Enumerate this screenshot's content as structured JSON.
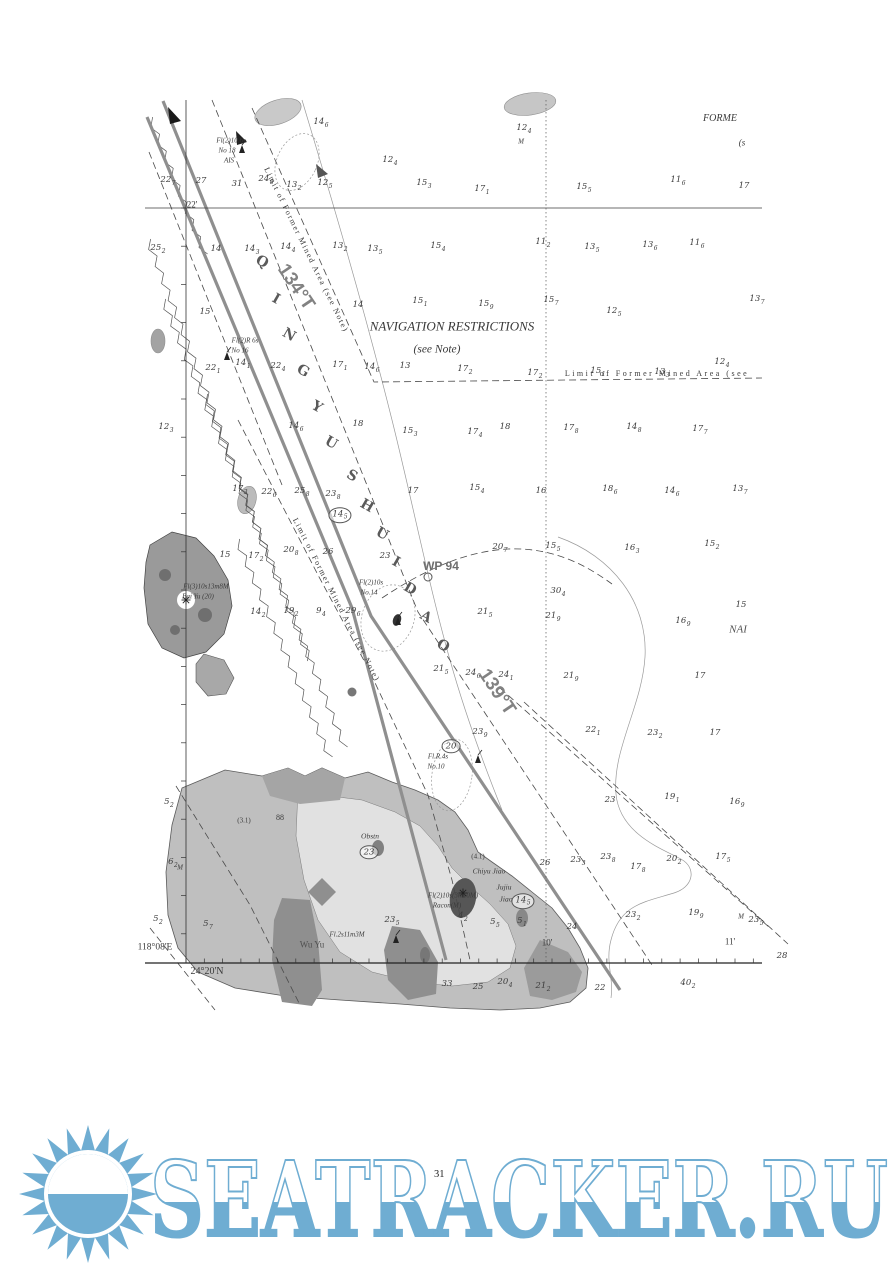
{
  "page": {
    "number": "31"
  },
  "watermark": {
    "text": "SEATRACKER.RU",
    "color": "#6fadd2"
  },
  "chart": {
    "colors": {
      "ink": "#3a3a3a",
      "track": "#8f8f8f",
      "land_outer": "#bfbfbf",
      "land_inner": "#e1e1e1",
      "rock": "#8f8f8f"
    },
    "channel_name": {
      "name": "QINGYU SHUIDAO",
      "letters": [
        {
          "ch": "Q",
          "x": 262,
          "y": 262
        },
        {
          "ch": "I",
          "x": 276,
          "y": 299
        },
        {
          "ch": "N",
          "x": 289,
          "y": 335
        },
        {
          "ch": "G",
          "x": 303,
          "y": 371
        },
        {
          "ch": "Y",
          "x": 317,
          "y": 407
        },
        {
          "ch": "U",
          "x": 331,
          "y": 443
        },
        {
          "ch": "S",
          "x": 352,
          "y": 476
        },
        {
          "ch": "H",
          "x": 367,
          "y": 506
        },
        {
          "ch": "U",
          "x": 382,
          "y": 534
        },
        {
          "ch": "I",
          "x": 396,
          "y": 562
        },
        {
          "ch": "D",
          "x": 410,
          "y": 589
        },
        {
          "ch": "A",
          "x": 426,
          "y": 617
        },
        {
          "ch": "O",
          "x": 443,
          "y": 646
        }
      ]
    },
    "labels": [
      {
        "t": "NAVIGATION RESTRICTIONS",
        "x": 452,
        "y": 326,
        "s": 13,
        "i": 1,
        "n": "navigation-restrictions-title"
      },
      {
        "t": "(see Note)",
        "x": 437,
        "y": 350,
        "s": 11.5,
        "i": 1,
        "n": "navigation-restrictions-note"
      },
      {
        "t": "Limit of Former Mined Area (see",
        "x": 657,
        "y": 374,
        "s": 8,
        "ls": 2.5,
        "n": "mined-area-limit-label-horizontal"
      },
      {
        "t": "Limit of Former Mined Area (see Note)",
        "x": 306,
        "y": 250,
        "s": 8,
        "ls": 1.5,
        "r": 64,
        "n": "mined-area-limit-label-upper"
      },
      {
        "t": "Limit of Former Mined Area (see Note)",
        "x": 336,
        "y": 600,
        "s": 8,
        "ls": 1.5,
        "r": 63,
        "n": "mined-area-limit-label-left"
      },
      {
        "t": "WP 94",
        "x": 441,
        "y": 566,
        "s": 12,
        "b": 1,
        "c": "#6e6e6e",
        "f": "sans",
        "n": "waypoint-label"
      },
      {
        "t": "134°T",
        "x": 296,
        "y": 287,
        "s": 19,
        "b": 1,
        "r": 56,
        "c": "#828282",
        "f": "sans",
        "n": "course-label-134"
      },
      {
        "t": "139°T",
        "x": 497,
        "y": 692,
        "s": 19,
        "b": 1,
        "r": 56,
        "c": "#828282",
        "f": "sans",
        "n": "course-label-139"
      },
      {
        "t": "Fl(2)10.6s",
        "x": 231,
        "y": 141,
        "s": 7,
        "i": 1,
        "n": "light-label-no18"
      },
      {
        "t": "No 18",
        "x": 227,
        "y": 151,
        "s": 7,
        "i": 1,
        "n": "light-label-no18"
      },
      {
        "t": "AIS",
        "x": 229,
        "y": 161,
        "s": 7,
        "i": 1,
        "n": "light-label-no18-ais"
      },
      {
        "t": "Fl(2)R 6s",
        "x": 245,
        "y": 341,
        "s": 7,
        "i": 1,
        "n": "light-label-no16"
      },
      {
        "t": "No 16",
        "x": 240,
        "y": 351,
        "s": 7,
        "i": 1,
        "n": "light-label-no16"
      },
      {
        "t": "Fl(3)10s13m8M",
        "x": 206,
        "y": 587,
        "s": 7,
        "i": 1,
        "n": "light-label-bai-yu"
      },
      {
        "t": "Bai Yu (20)",
        "x": 198,
        "y": 597,
        "s": 7,
        "i": 1,
        "n": "place-label-bai-yu"
      },
      {
        "t": "Fl(2)10s",
        "x": 371,
        "y": 583,
        "s": 7,
        "i": 1,
        "n": "light-label-no14"
      },
      {
        "t": "No.14",
        "x": 369,
        "y": 593,
        "s": 7,
        "i": 1,
        "n": "light-label-no14"
      },
      {
        "t": "Fl.R.4s",
        "x": 438,
        "y": 757,
        "s": 7,
        "i": 1,
        "n": "light-label-no10"
      },
      {
        "t": "No.10",
        "x": 436,
        "y": 767,
        "s": 7,
        "i": 1,
        "n": "light-label-no10"
      },
      {
        "t": "Fl.2s11m3M",
        "x": 347,
        "y": 935,
        "s": 7,
        "i": 1,
        "n": "light-label-wu-yu"
      },
      {
        "t": "Fl(2)10s(3m10M)",
        "x": 453,
        "y": 896,
        "s": 7,
        "i": 1,
        "n": "light-label-chiyu"
      },
      {
        "t": "Racon(M)",
        "x": 447,
        "y": 906,
        "s": 7,
        "i": 1,
        "n": "racon-label"
      },
      {
        "t": "Chiyu Jiao",
        "x": 489,
        "y": 871,
        "s": 7.5,
        "i": 1,
        "n": "place-label-chiyu-jiao"
      },
      {
        "t": "Jujiu",
        "x": 504,
        "y": 887,
        "s": 7.5,
        "i": 1,
        "n": "place-label-jujiu-jiao"
      },
      {
        "t": "Jiao",
        "x": 506,
        "y": 899,
        "s": 7.5,
        "i": 1,
        "n": "place-label-jujiu-jiao"
      },
      {
        "t": "Wu Yu",
        "x": 312,
        "y": 945,
        "s": 9,
        "c": "#4f4f4f",
        "n": "place-label-wu-yu"
      },
      {
        "t": "Obstn",
        "x": 370,
        "y": 836,
        "s": 7.5,
        "i": 1,
        "n": "obstruction-label"
      },
      {
        "t": "88",
        "x": 280,
        "y": 818,
        "s": 8,
        "n": "height-label"
      },
      {
        "t": "(3.1)",
        "x": 244,
        "y": 821,
        "s": 7,
        "n": "drying-height-label"
      },
      {
        "t": "(4.1)",
        "x": 478,
        "y": 857,
        "s": 7,
        "n": "drying-height-label"
      },
      {
        "t": "22'",
        "x": 192,
        "y": 205,
        "s": 9,
        "n": "latitude-label-22"
      },
      {
        "t": "118°08'E",
        "x": 155,
        "y": 948,
        "s": 9.5,
        "n": "longitude-label-118-08"
      },
      {
        "t": "24°20'N",
        "x": 207,
        "y": 972,
        "s": 10,
        "n": "latitude-label-24-20"
      },
      {
        "t": "10'",
        "x": 547,
        "y": 943,
        "s": 9,
        "n": "longitude-label-10"
      },
      {
        "t": "11'",
        "x": 730,
        "y": 942,
        "s": 9,
        "n": "longitude-label-11"
      },
      {
        "t": "FORME",
        "x": 720,
        "y": 119,
        "s": 10,
        "i": 1,
        "n": "partial-label-former"
      },
      {
        "t": "(s",
        "x": 742,
        "y": 143,
        "s": 9,
        "i": 1,
        "n": "partial-label-see"
      },
      {
        "t": "NAI",
        "x": 738,
        "y": 630,
        "s": 11,
        "i": 1,
        "c": "#555555",
        "n": "partial-label-nav"
      },
      {
        "t": "M",
        "x": 521,
        "y": 142,
        "s": 7,
        "i": 1,
        "n": "seabed-label-mud"
      },
      {
        "t": "M",
        "x": 180,
        "y": 868,
        "s": 7,
        "i": 1,
        "n": "seabed-label-mud"
      },
      {
        "t": "M",
        "x": 741,
        "y": 917,
        "s": 7,
        "i": 1,
        "n": "seabed-label-mud"
      }
    ],
    "soundings": [
      [
        321,
        123,
        "14",
        "6"
      ],
      [
        524,
        129,
        "12",
        "4"
      ],
      [
        390,
        161,
        "12",
        "4"
      ],
      [
        168,
        181,
        "22",
        "7"
      ],
      [
        201,
        181,
        "27",
        ""
      ],
      [
        237,
        184,
        "31",
        ""
      ],
      [
        266,
        180,
        "24",
        "8"
      ],
      [
        294,
        186,
        "13",
        "2"
      ],
      [
        325,
        184,
        "12",
        "5"
      ],
      [
        424,
        184,
        "15",
        "3"
      ],
      [
        482,
        190,
        "17",
        "1"
      ],
      [
        584,
        188,
        "15",
        "5"
      ],
      [
        678,
        181,
        "11",
        "6"
      ],
      [
        744,
        186,
        "17",
        ""
      ],
      [
        158,
        249,
        "25",
        "2"
      ],
      [
        216,
        249,
        "14",
        ""
      ],
      [
        252,
        250,
        "14",
        "3"
      ],
      [
        288,
        248,
        "14",
        "4"
      ],
      [
        340,
        247,
        "13",
        "2"
      ],
      [
        375,
        250,
        "13",
        "5"
      ],
      [
        438,
        247,
        "15",
        "4"
      ],
      [
        543,
        243,
        "11",
        "2"
      ],
      [
        592,
        248,
        "13",
        "5"
      ],
      [
        650,
        246,
        "13",
        "6"
      ],
      [
        697,
        244,
        "11",
        "6"
      ],
      [
        205,
        312,
        "15",
        ""
      ],
      [
        358,
        305,
        "14",
        ""
      ],
      [
        420,
        302,
        "15",
        "1"
      ],
      [
        486,
        305,
        "15",
        "9"
      ],
      [
        551,
        301,
        "15",
        "7"
      ],
      [
        614,
        312,
        "12",
        "5"
      ],
      [
        757,
        300,
        "13",
        "7"
      ],
      [
        213,
        369,
        "22",
        "1"
      ],
      [
        243,
        364,
        "14",
        "1"
      ],
      [
        278,
        367,
        "22",
        "4"
      ],
      [
        340,
        366,
        "17",
        "1"
      ],
      [
        372,
        368,
        "14",
        "6"
      ],
      [
        405,
        366,
        "13",
        ""
      ],
      [
        465,
        370,
        "17",
        "2"
      ],
      [
        535,
        374,
        "17",
        "2"
      ],
      [
        598,
        372,
        "15",
        "1"
      ],
      [
        662,
        373,
        "13",
        "3"
      ],
      [
        722,
        363,
        "12",
        "4"
      ],
      [
        166,
        428,
        "12",
        "3"
      ],
      [
        296,
        427,
        "14",
        "6"
      ],
      [
        358,
        424,
        "18",
        ""
      ],
      [
        410,
        432,
        "15",
        "3"
      ],
      [
        475,
        433,
        "17",
        "4"
      ],
      [
        505,
        427,
        "18",
        ""
      ],
      [
        571,
        429,
        "17",
        "8"
      ],
      [
        634,
        428,
        "14",
        "8"
      ],
      [
        700,
        430,
        "17",
        "7"
      ],
      [
        240,
        490,
        "17",
        "3"
      ],
      [
        269,
        493,
        "22",
        "6"
      ],
      [
        302,
        492,
        "25",
        "8"
      ],
      [
        333,
        495,
        "23",
        "8"
      ],
      [
        413,
        491,
        "17",
        ""
      ],
      [
        477,
        489,
        "15",
        "4"
      ],
      [
        541,
        491,
        "16",
        ""
      ],
      [
        610,
        490,
        "18",
        "6"
      ],
      [
        672,
        492,
        "14",
        "6"
      ],
      [
        740,
        490,
        "13",
        "7"
      ],
      [
        385,
        556,
        "23",
        ""
      ],
      [
        225,
        555,
        "15",
        ""
      ],
      [
        256,
        557,
        "17",
        "2"
      ],
      [
        291,
        551,
        "20",
        "8"
      ],
      [
        328,
        552,
        "26",
        ""
      ],
      [
        500,
        548,
        "20",
        "7"
      ],
      [
        553,
        547,
        "15",
        "5"
      ],
      [
        632,
        549,
        "16",
        "3"
      ],
      [
        712,
        545,
        "15",
        "2"
      ],
      [
        558,
        592,
        "30",
        "4"
      ],
      [
        485,
        613,
        "21",
        "5"
      ],
      [
        553,
        617,
        "21",
        "9"
      ],
      [
        683,
        622,
        "16",
        "9"
      ],
      [
        741,
        605,
        "15",
        ""
      ],
      [
        258,
        613,
        "14",
        "2"
      ],
      [
        291,
        612,
        "19",
        "2"
      ],
      [
        321,
        612,
        "9",
        "4"
      ],
      [
        353,
        612,
        "29",
        "6"
      ],
      [
        441,
        670,
        "21",
        "5"
      ],
      [
        473,
        674,
        "24",
        "6"
      ],
      [
        506,
        676,
        "24",
        "1"
      ],
      [
        571,
        677,
        "21",
        "9"
      ],
      [
        700,
        676,
        "17",
        ""
      ],
      [
        480,
        733,
        "23",
        "9"
      ],
      [
        593,
        731,
        "22",
        "1"
      ],
      [
        655,
        734,
        "23",
        "2"
      ],
      [
        715,
        733,
        "17",
        ""
      ],
      [
        610,
        800,
        "23",
        ""
      ],
      [
        672,
        798,
        "19",
        "1"
      ],
      [
        737,
        803,
        "16",
        "9"
      ],
      [
        545,
        863,
        "26",
        ""
      ],
      [
        578,
        861,
        "23",
        "3"
      ],
      [
        608,
        858,
        "23",
        "8"
      ],
      [
        638,
        868,
        "17",
        "8"
      ],
      [
        674,
        860,
        "20",
        "2"
      ],
      [
        723,
        858,
        "17",
        "5"
      ],
      [
        572,
        927,
        "24",
        ""
      ],
      [
        633,
        916,
        "23",
        "2"
      ],
      [
        696,
        914,
        "19",
        "9"
      ],
      [
        463,
        917,
        "4",
        "2"
      ],
      [
        495,
        923,
        "5",
        "5"
      ],
      [
        522,
        922,
        "5",
        "1"
      ],
      [
        392,
        921,
        "23",
        "5"
      ],
      [
        756,
        921,
        "23",
        "5"
      ],
      [
        782,
        956,
        "28",
        ""
      ],
      [
        173,
        863,
        "6",
        "2"
      ],
      [
        169,
        803,
        "5",
        "2"
      ],
      [
        158,
        920,
        "5",
        "2"
      ],
      [
        208,
        925,
        "5",
        "7"
      ],
      [
        447,
        984,
        "33",
        ""
      ],
      [
        478,
        987,
        "25",
        ""
      ],
      [
        505,
        983,
        "20",
        "4"
      ],
      [
        543,
        987,
        "21",
        "2"
      ],
      [
        600,
        988,
        "22",
        ""
      ],
      [
        688,
        984,
        "40",
        "2"
      ]
    ],
    "circled_soundings": [
      [
        340,
        515,
        "14",
        "5"
      ],
      [
        451,
        746,
        "20",
        ""
      ],
      [
        369,
        852,
        "23",
        ""
      ],
      [
        523,
        901,
        "14",
        "5"
      ]
    ]
  }
}
